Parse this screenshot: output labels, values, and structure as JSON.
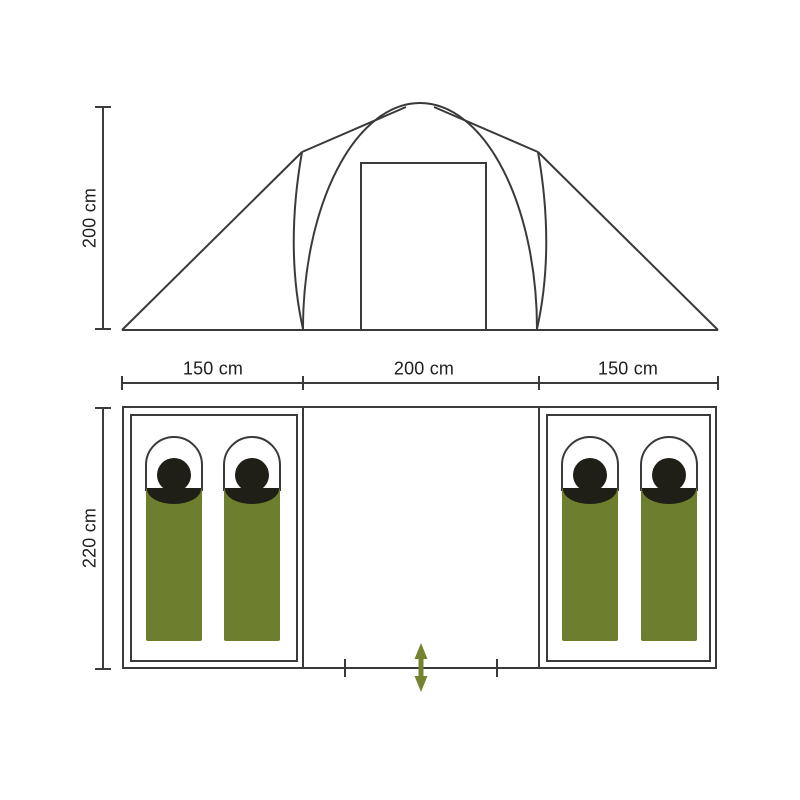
{
  "elevation_view": {
    "height_dimension": "200 cm"
  },
  "floor_plan_view": {
    "section_width_dimensions": [
      "150 cm",
      "200 cm",
      "150 cm"
    ],
    "depth_dimension": "220 cm",
    "left_cabin": {
      "sleeping_bag_count": 2
    },
    "right_cabin": {
      "sleeping_bag_count": 2
    },
    "entrance_marker": "double-arrow"
  },
  "colors": {
    "outline": "#3a3a3a",
    "sleeping_bag_green": "#6d7e2e",
    "entrance_arrow_green": "#75832e",
    "sleeping_bag_dark": "#1f1f17",
    "sleeping_bag_hood_fill": "#ffffff",
    "background": "#ffffff"
  }
}
